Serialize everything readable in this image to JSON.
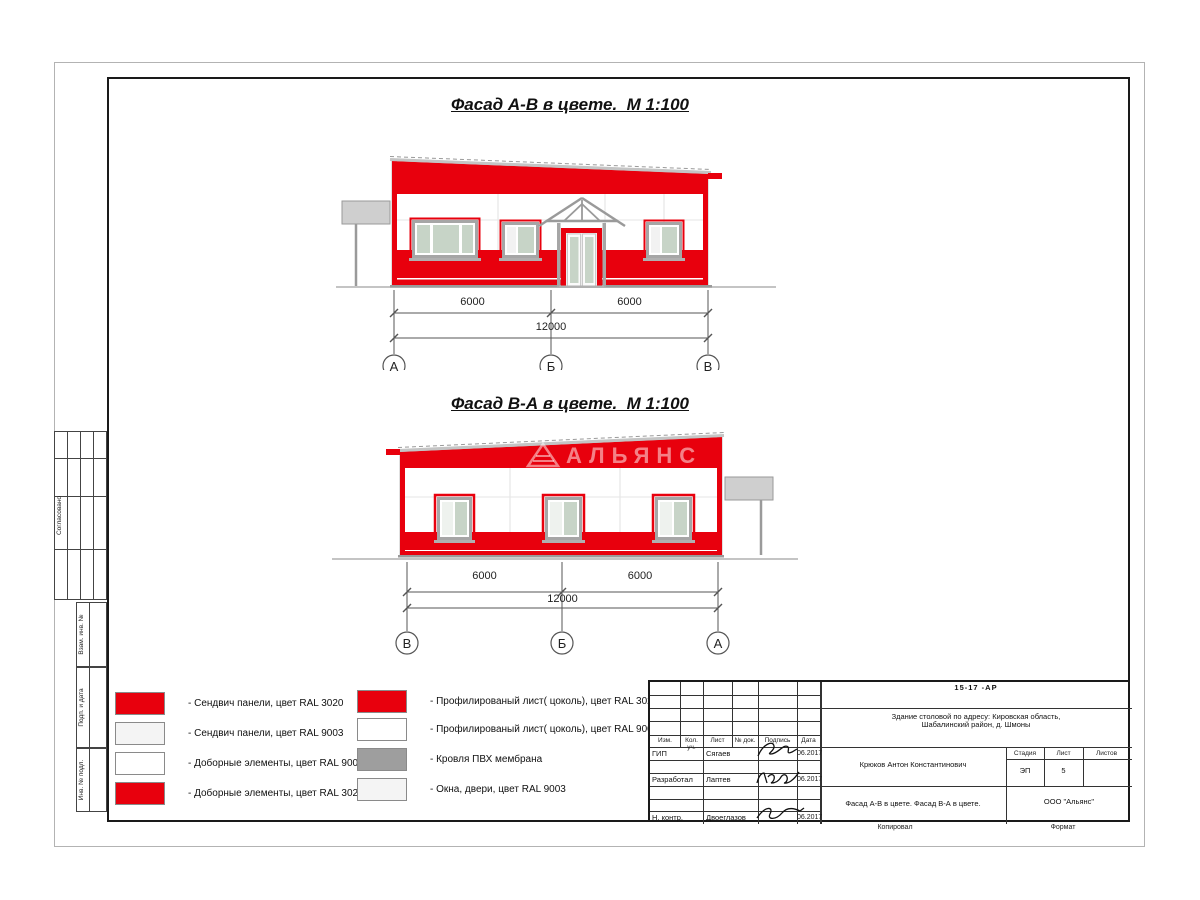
{
  "colors": {
    "red_ral3020": "#e8000d",
    "white_ral9003": "#ffffff",
    "offwhite": "#f4f4f4",
    "roof_gray": "#9e9e9e",
    "glass": "#c7d4c7"
  },
  "facade1": {
    "title": "Фасад А-В в цвете.  М 1:100",
    "dim_left": "6000",
    "dim_right": "6000",
    "dim_total": "12000",
    "axis_left": "А",
    "axis_mid": "Б",
    "axis_right": "В"
  },
  "facade2": {
    "title": "Фасад В-А в цвете.  М 1:100",
    "dim_left": "6000",
    "dim_right": "6000",
    "dim_total": "12000",
    "axis_left": "В",
    "axis_mid": "Б",
    "axis_right": "А",
    "watermark": "АЛЬЯНС"
  },
  "legend": {
    "left": [
      {
        "color": "#e8000d",
        "label": "- Сендвич панели, цвет RAL 3020"
      },
      {
        "color": "#f4f4f4",
        "label": "- Сендвич панели, цвет RAL 9003"
      },
      {
        "color": "#ffffff",
        "label": "- Доборные элементы, цвет RAL 9003"
      },
      {
        "color": "#e8000d",
        "label": "- Доборные элементы, цвет RAL 3020"
      }
    ],
    "right": [
      {
        "color": "#e8000d",
        "label": "- Профилированый лист( цоколь), цвет RAL 3020"
      },
      {
        "color": "#ffffff",
        "label": "- Профилированый лист( цоколь), цвет RAL 9003"
      },
      {
        "color": "#9e9e9e",
        "label": "- Кровля ПВХ мембрана"
      },
      {
        "color": "#f4f4f4",
        "label": "- Окна, двери, цвет RAL 9003"
      }
    ]
  },
  "title_block": {
    "doc_number": "15-17 -АР",
    "project_line1": "Здание столовой по адресу: Кировская область,",
    "project_line2": "Шабалинский район, д. Шмоны",
    "chief_name": "Крюков Антон Константинович",
    "sheet_title": "Фасад А-В в цвете. Фасад В-А в цвете.",
    "company": "ООО \"Альянс\"",
    "stage_label": "Стадия",
    "sheet_label": "Лист",
    "sheets_label": "Листов",
    "stage_value": "ЭП",
    "sheet_value": "5",
    "sheets_value": "",
    "col_headers": [
      "Изм.",
      "Кол. уч.",
      "Лист",
      "№ док.",
      "Подпись",
      "Дата"
    ],
    "rows": [
      {
        "role": "ГИП",
        "name": "Сягаев",
        "date": "06.2017"
      },
      {
        "role": "Разработал",
        "name": "Лаптев",
        "date": "06.2017"
      },
      {
        "role": "Н. контр.",
        "name": "Двоеглазов",
        "date": "06.2017"
      }
    ],
    "footer_copy": "Копировал",
    "footer_format": "Формат"
  },
  "side_stamp": {
    "agreed": "Согласовано",
    "vzam": "Взам. инв. №",
    "podp": "Подп. и дата",
    "inv": "Инв. № подл."
  }
}
